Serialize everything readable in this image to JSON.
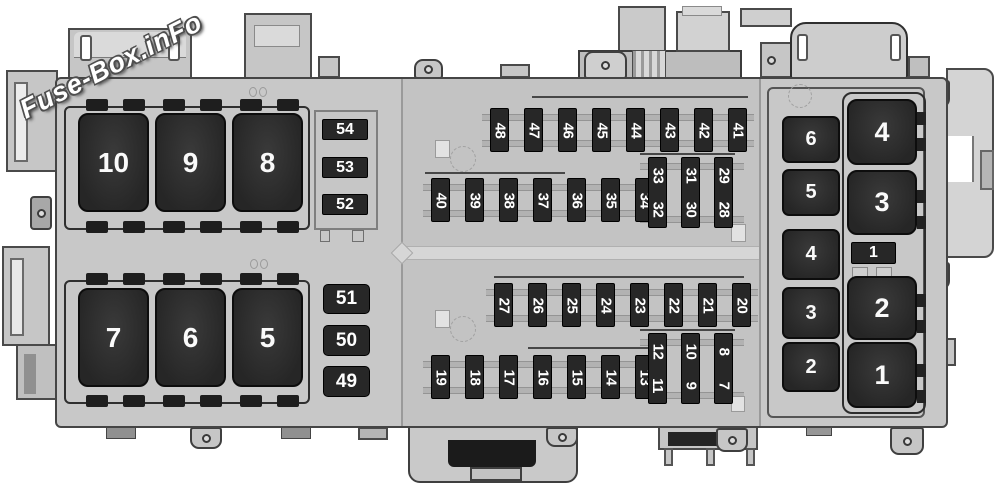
{
  "watermark": {
    "text": "Fuse-Box.inFo"
  },
  "left_section": {
    "top_relays": [
      "10",
      "9",
      "8"
    ],
    "top_fuses": [
      "54",
      "53",
      "52"
    ],
    "bottom_relays": [
      "7",
      "6",
      "5"
    ],
    "bottom_fuses": [
      "51",
      "50",
      "49"
    ]
  },
  "middle_section": {
    "top_row": [
      "48",
      "47",
      "46",
      "45",
      "44",
      "43",
      "42",
      "41"
    ],
    "mid_row": [
      "40",
      "39",
      "38",
      "37",
      "36",
      "35",
      "34"
    ],
    "mid_tall": [
      {
        "top": "33",
        "bottom": "32"
      },
      {
        "top": "31",
        "bottom": "30"
      },
      {
        "top": "29",
        "bottom": "28"
      }
    ],
    "low_row": [
      "27",
      "26",
      "25",
      "24",
      "23",
      "22",
      "21",
      "20"
    ],
    "bottom_row": [
      "19",
      "18",
      "17",
      "16",
      "15",
      "14",
      "13"
    ],
    "bottom_tall": [
      {
        "top": "12",
        "bottom": "11"
      },
      {
        "top": "10",
        "bottom": "9"
      },
      {
        "top": "8",
        "bottom": "7"
      }
    ]
  },
  "right_section": {
    "small_relays": [
      "6",
      "5",
      "4",
      "3",
      "2"
    ],
    "large_relays_top": [
      "4",
      "3"
    ],
    "fuse": "1",
    "large_relays_bottom": [
      "2",
      "1"
    ]
  },
  "colors": {
    "housing": "#c8c8c8",
    "component_dark": "#272727",
    "label_light": "#fafafa",
    "outline": "#454545"
  }
}
